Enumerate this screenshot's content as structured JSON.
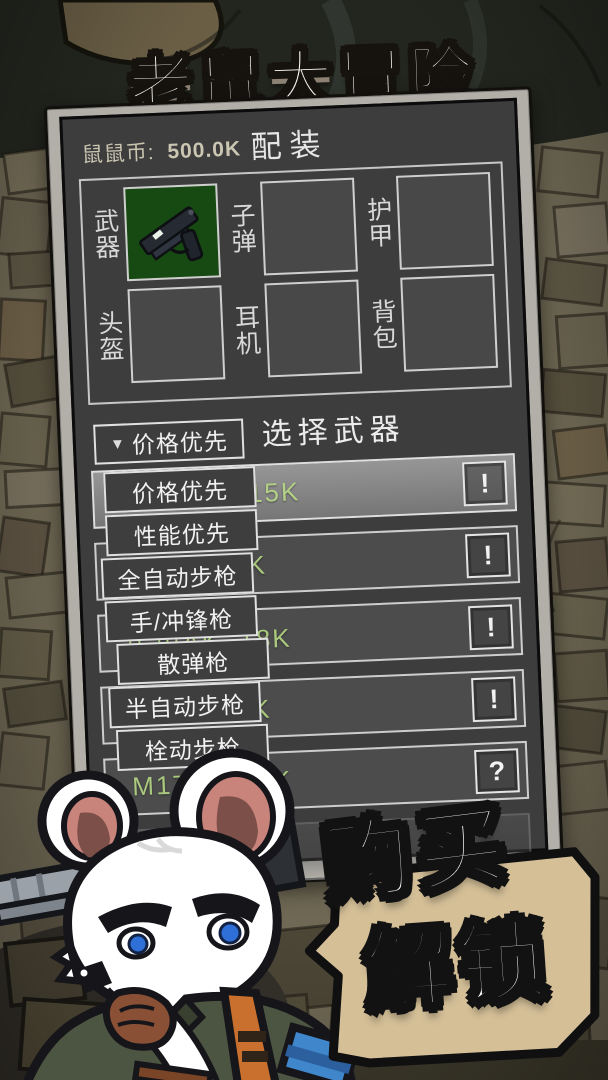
{
  "title": "老鼠大冒险",
  "wallet": {
    "label": "鼠鼠币:",
    "value": "500.0K"
  },
  "page": {
    "heading": "配装"
  },
  "equipment": {
    "slots": [
      {
        "label": "武器",
        "filled": true,
        "icon": "pistol-icon"
      },
      {
        "label": "子弹",
        "filled": false
      },
      {
        "label": "护甲",
        "filled": false
      },
      {
        "label": "头盔",
        "filled": false
      },
      {
        "label": "耳机",
        "filled": false
      },
      {
        "label": "背包",
        "filled": false
      }
    ]
  },
  "weapon_select": {
    "section_title": "选择武器",
    "filter": {
      "arrow_icon": "▼",
      "selected": "价格优先",
      "options": [
        "价格优先",
        "性能优先",
        "全自动步枪",
        "手/冲锋枪",
        "散弹枪",
        "半自动步枪",
        "栓动步枪"
      ]
    },
    "rows": [
      {
        "label": "Glock17, 15K",
        "action": "!",
        "state": "selected"
      },
      {
        "label": "M870, 16K",
        "action": "!",
        "state": "locked"
      },
      {
        "label": "民用AK, 18K",
        "action": "!",
        "state": "locked"
      },
      {
        "label": "PP19, 21K",
        "action": "!",
        "state": "locked"
      },
      {
        "label": "M1700, 20K",
        "action": "?",
        "state": "locked"
      },
      {
        "label": "AKM",
        "action": "",
        "state": "disabled"
      }
    ]
  },
  "promo": {
    "line1": "购买",
    "line2": "解锁"
  },
  "colors": {
    "accent_green": "#a9c87d",
    "panel_gray": "#3d3d3d",
    "bubble_tan": "#d4bf97",
    "weapon_slot_green": "#174a12",
    "border_light": "#e0e0e0"
  }
}
